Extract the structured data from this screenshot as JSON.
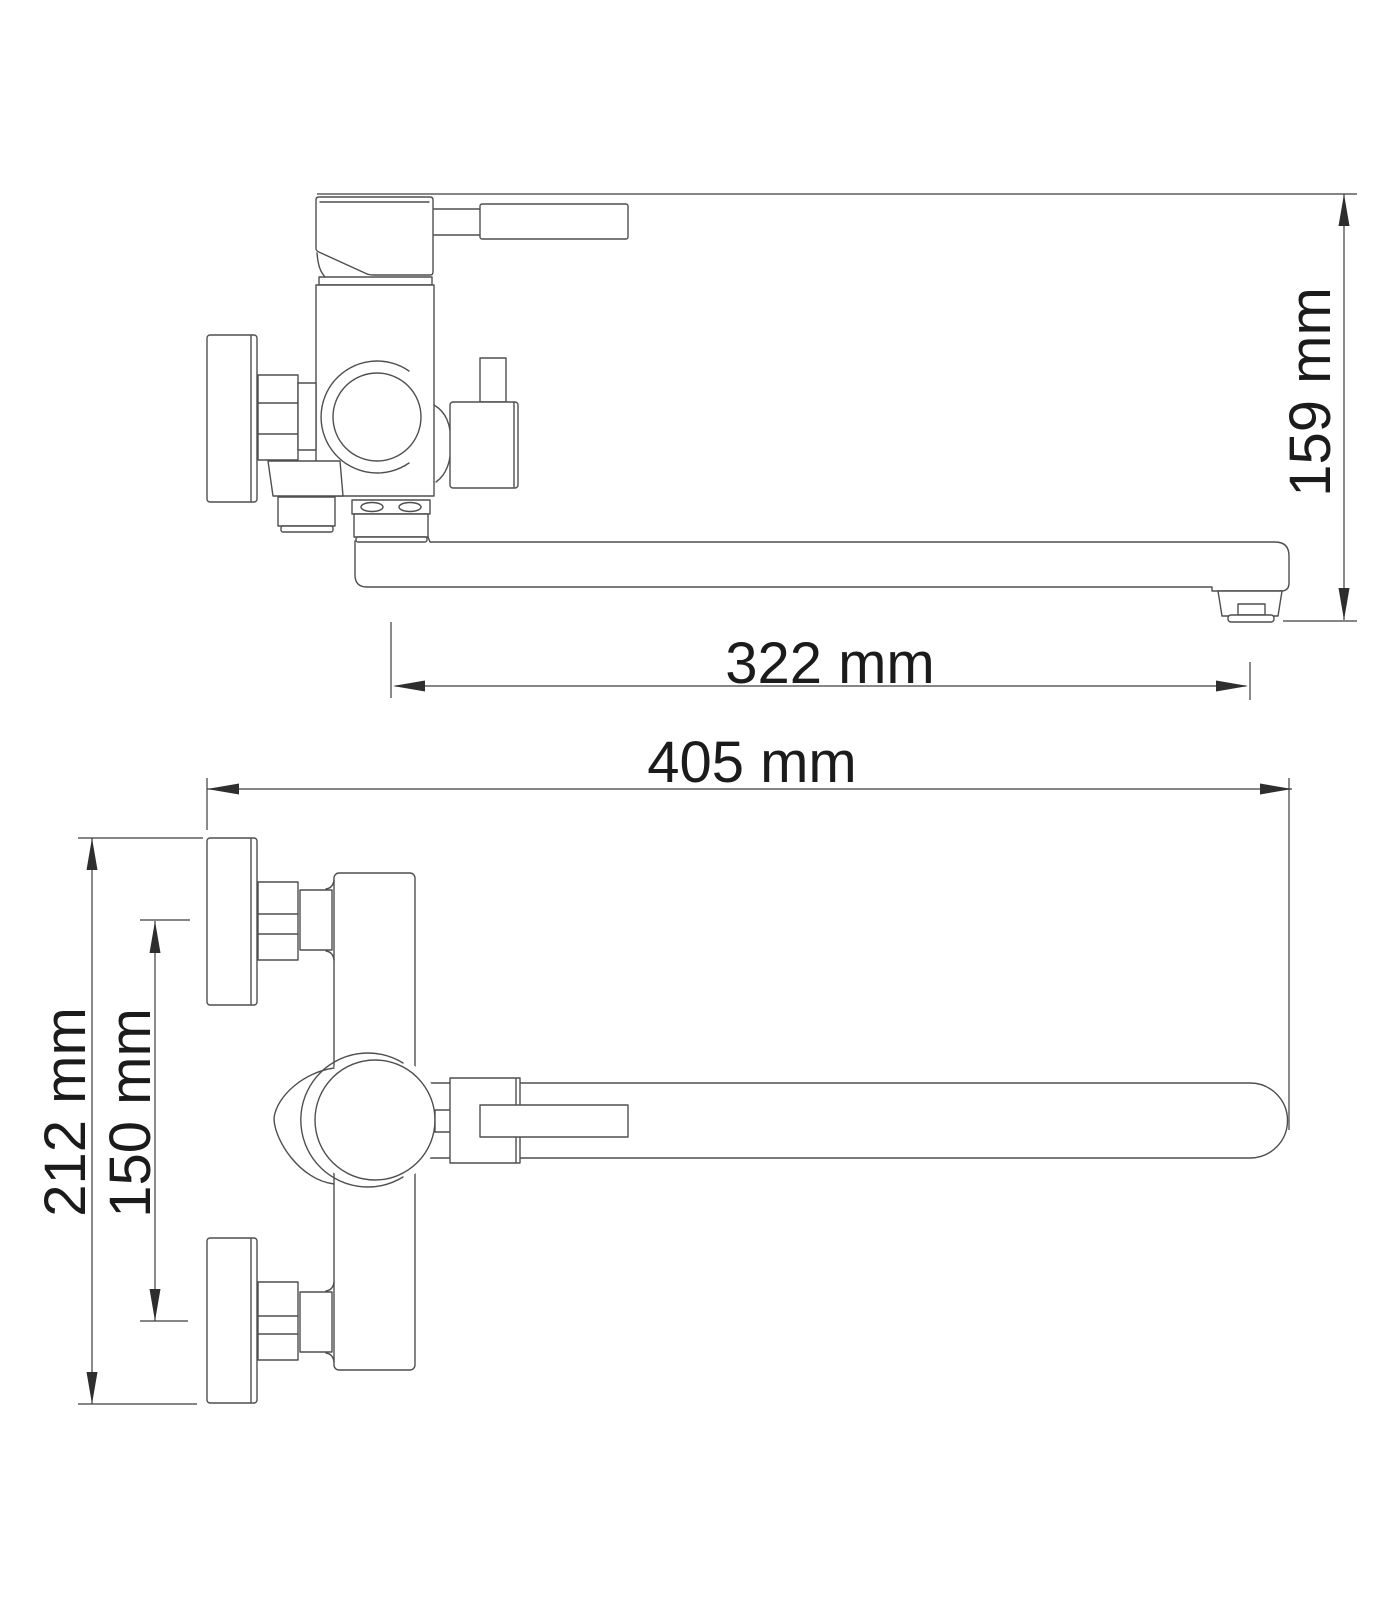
{
  "colors": {
    "background": "#ffffff",
    "part_line": "#4f4f4f",
    "dimension_line": "#3d3d3d",
    "text": "#1b1b1b"
  },
  "drawing": {
    "title": "Wall-mounted bath mixer faucet with long swivel spout — dimensional drawing, two orthographic views",
    "dimensions": {
      "overall_height": {
        "label": "159 mm",
        "value": 159,
        "unit": "mm"
      },
      "spout_reach": {
        "label": "322 mm",
        "value": 322,
        "unit": "mm"
      },
      "overall_length": {
        "label": "405 mm",
        "value": 405,
        "unit": "mm"
      },
      "body_span": {
        "label": "212 mm",
        "value": 212,
        "unit": "mm"
      },
      "connection_centers": {
        "label": "150 mm",
        "value": 150,
        "unit": "mm"
      }
    }
  }
}
